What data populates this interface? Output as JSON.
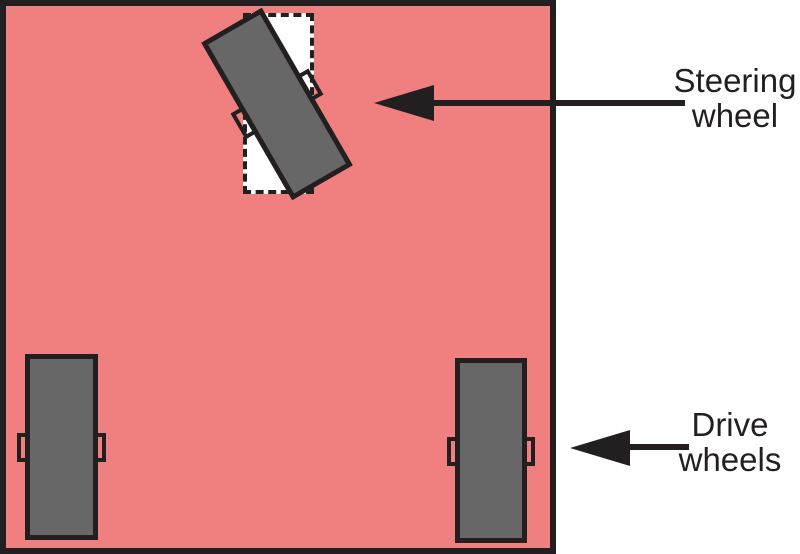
{
  "diagram": {
    "subject": "robot chassis top view with one steering wheel and two drive wheels"
  },
  "labels": {
    "steering": "Steering\nwheel",
    "drive": "Drive\nwheels"
  },
  "icons": {
    "steering_pointer": "arrowhead-left",
    "drive_pointer": "arrowhead-left",
    "axle_tab": "small-outlined-rectangle"
  },
  "colors": {
    "body-fill": "#F08080",
    "wheel-fill": "#676767",
    "slot-fill": "#FFFFFF",
    "outline": "#231F20",
    "background": "#FFFFFF"
  }
}
